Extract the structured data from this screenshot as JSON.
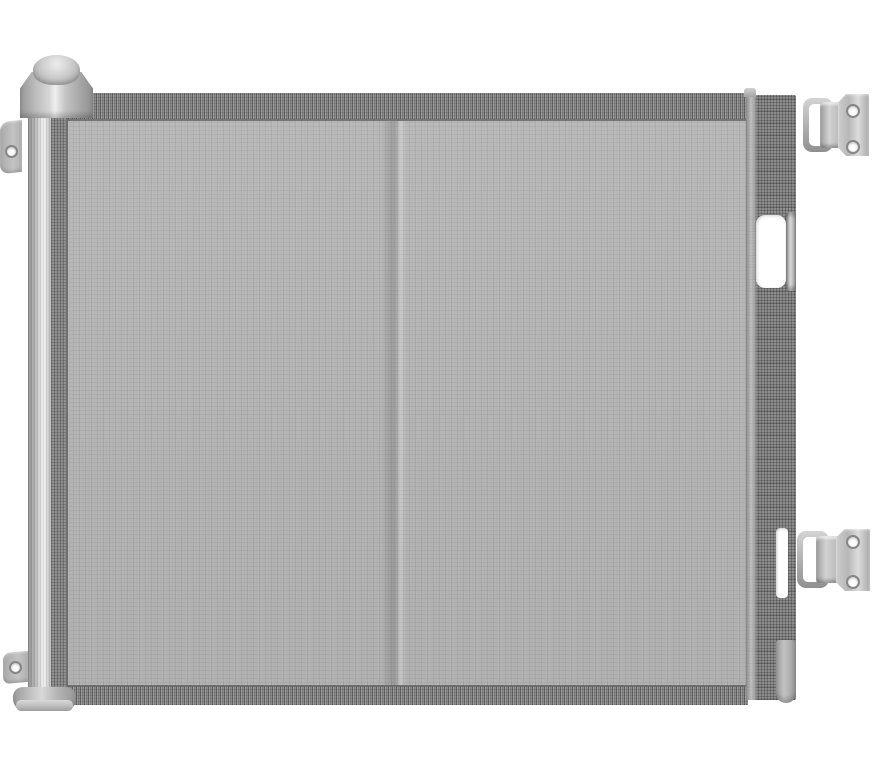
{
  "scene": {
    "type": "product-photo",
    "subject": "Retractable mesh safety gate, gray, shown extended between a left roller post and right wall-mount brackets",
    "components": {
      "roller_dome": "roller post dome cap",
      "roller_collar": "roller post top collar",
      "roller_post": "left spring roller post",
      "rolled_mesh": "mesh wound on roller",
      "roller_base": "roller post floor base",
      "wall_tab_top": "upper wall-mount tab with screw hole",
      "wall_tab_bottom": "lower wall-mount tab with screw hole",
      "mesh_panel": "retractable gray mesh fabric panel",
      "mesh_band_top": "woven reinforcement band, top edge",
      "mesh_band_bottom": "woven reinforcement band, bottom edge",
      "mesh_fold": "vertical center fold crease in mesh",
      "gate_bar": "right latch bar of gate",
      "handle_cutout": "handle cutout opening in latch bar",
      "handle_rod": "handle pull rod inside cutout",
      "latch_slot": "lower latch slot in bar",
      "latch_rod_bottom": "bottom latch rod",
      "bracket_top": "upper wall bracket with U-hook and two screw holes",
      "bracket_bottom": "lower wall bracket with U-hook and two screw holes"
    }
  },
  "colors": {
    "background": "#ffffff",
    "mesh_base": "#b6b6b6",
    "band_base": "#8e8e8e",
    "bar_base": "#8d8d8d",
    "metal_light": "#dcdcdc",
    "metal_mid": "#b5b5b5",
    "metal_dark": "#8a8a8a",
    "seam_dark": "#6f6f6f"
  }
}
